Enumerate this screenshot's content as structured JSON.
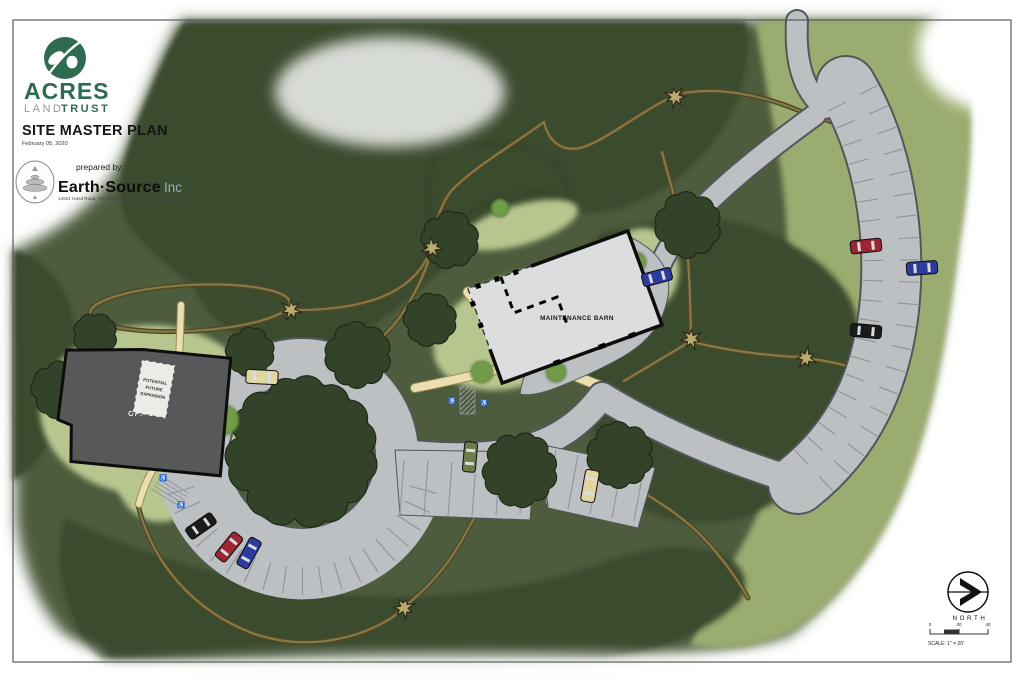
{
  "title_block": {
    "org_name": "ACRES",
    "org_land": "LAND",
    "org_trust": "TRUST",
    "plan_title": "SITE MASTER PLAN",
    "plan_date": "February 05, 2020",
    "prepared_by": "prepared by:",
    "firm_name": "Earth·Source",
    "firm_suffix": "Inc",
    "firm_address": "14921 Hand Road, Fort Wayne, IN 46818",
    "firm_phone": "(260)489-8511"
  },
  "map": {
    "labels": {
      "office": "OFFICE",
      "maintenance_barn": "MAINTENANCE BARN",
      "expansion_1": "POTENTIAL",
      "expansion_2": "FUTURE",
      "expansion_3": "EXPANSION"
    },
    "icons": {
      "accessible": "♿"
    },
    "cars": [
      {
        "name": "car-blue-barn",
        "color": "car_blue",
        "x": 657,
        "y": 277,
        "rot": -15,
        "w": 30,
        "h": 13
      },
      {
        "name": "car-red-east-lot",
        "color": "car_red",
        "x": 866,
        "y": 246,
        "rot": -6,
        "w": 31,
        "h": 13
      },
      {
        "name": "car-blue-east-lot",
        "color": "car_blue",
        "x": 922,
        "y": 268,
        "rot": -4,
        "w": 31,
        "h": 13
      },
      {
        "name": "car-black-east-lot",
        "color": "car_black",
        "x": 866,
        "y": 331,
        "rot": 5,
        "w": 31,
        "h": 13
      },
      {
        "name": "car-black-loop",
        "color": "car_black",
        "x": 201,
        "y": 526,
        "rot": 145,
        "w": 31,
        "h": 13
      },
      {
        "name": "car-red-loop",
        "color": "car_red",
        "x": 229,
        "y": 547,
        "rot": 129,
        "w": 31,
        "h": 13
      },
      {
        "name": "car-blue-loop",
        "color": "car_blue",
        "x": 249,
        "y": 553,
        "rot": 119,
        "w": 31,
        "h": 13
      },
      {
        "name": "car-olive-central",
        "color": "car_olive",
        "x": 470,
        "y": 457,
        "rot": 95,
        "w": 30,
        "h": 13
      },
      {
        "name": "truck-tan-central",
        "color": "car_tan",
        "x": 590,
        "y": 486,
        "rot": 100,
        "w": 32,
        "h": 14
      },
      {
        "name": "truck-tan-loop-road",
        "color": "car_tan",
        "x": 262,
        "y": 377,
        "rot": 3,
        "w": 32,
        "h": 14
      }
    ],
    "trail_nodes": [
      [
        675,
        97
      ],
      [
        432,
        248
      ],
      [
        291,
        310
      ],
      [
        691,
        339
      ],
      [
        806,
        358
      ],
      [
        404,
        608
      ]
    ]
  },
  "compass": {
    "label": "NORTH"
  },
  "scale_bar": {
    "ticks": [
      "0",
      "20",
      "40"
    ],
    "label": "SCALE: 1\" = 20'"
  },
  "colors": {
    "base_green": "#4d5c3c",
    "forest_green": "#3b4b2d",
    "forest_edge": "#222d18",
    "meadow_green": "#9cad72",
    "meadow_dot": "#7e9355",
    "lawn_green": "#b7c68e",
    "shrub_green": "#6f9b47",
    "road_gray": "#bdc0c3",
    "road_edge": "#53565a",
    "stall_line": "#8f9396",
    "path_tan": "#eadfb0",
    "path_edge": "#9c8d58",
    "trail_dark": "#4f4827",
    "trail_light": "#857a46",
    "office_gray": "#57585a",
    "barn_gray": "#dcddde",
    "building_edge": "#0d0d0d",
    "car_red": "#9e2633",
    "car_blue": "#2c3c9c",
    "car_black": "#1a1b1d",
    "car_olive": "#6e7c49",
    "car_tan": "#e0d6a2",
    "node_tan": "#b8ab6c",
    "brand_green": "#2e6b4f",
    "brand_gray": "#97999b"
  }
}
